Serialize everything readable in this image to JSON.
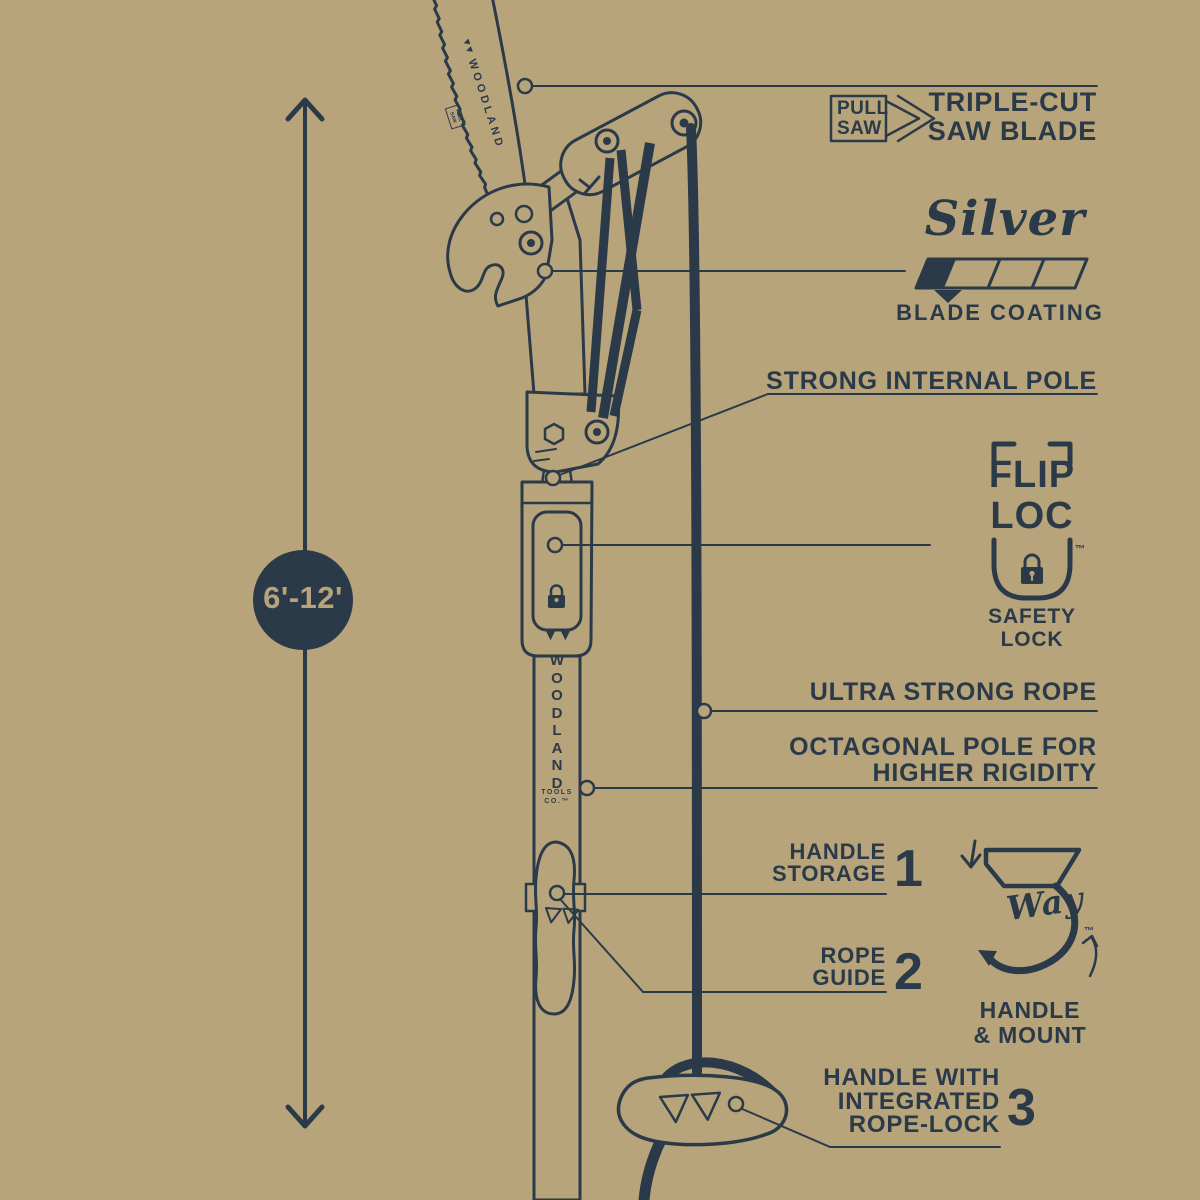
{
  "colors": {
    "background": "#b8a47b",
    "ink": "#2b3a48"
  },
  "measurement": {
    "range": "6'-12'"
  },
  "branding": {
    "blade_brand": "WOODLAND",
    "blade_stamp": "PULL SAW",
    "pole_letters": [
      "W",
      "O",
      "O",
      "D",
      "L",
      "A",
      "N",
      "D"
    ],
    "pole_tools": "TOOLS",
    "pole_co": "CO.™"
  },
  "labels": {
    "pull_saw": {
      "line1": "PULL",
      "line2": "SAW"
    },
    "triple_cut": {
      "line1": "TRIPLE-CUT",
      "line2": "SAW BLADE"
    },
    "silver": {
      "script": "Silver",
      "caption": "BLADE COATING"
    },
    "strong_internal_pole": "STRONG INTERNAL POLE",
    "flip_loc": {
      "line1": "FLIP",
      "line2": "LOC",
      "tm": "™",
      "caption1": "SAFETY",
      "caption2": "LOCK"
    },
    "ultra_strong_rope": "ULTRA STRONG ROPE",
    "octagonal_pole": {
      "line1": "OCTAGONAL POLE FOR",
      "line2": "HIGHER RIGIDITY"
    },
    "handle_storage": {
      "line1": "HANDLE",
      "line2": "STORAGE",
      "number": "1"
    },
    "rope_guide": {
      "line1": "ROPE",
      "line2": "GUIDE",
      "number": "2"
    },
    "three_way": {
      "script": "Way",
      "tm": "™",
      "caption1": "HANDLE",
      "caption2": "& MOUNT"
    },
    "handle_rope_lock": {
      "line1": "HANDLE WITH",
      "line2": "INTEGRATED",
      "line3": "ROPE-LOCK",
      "number": "3"
    }
  }
}
